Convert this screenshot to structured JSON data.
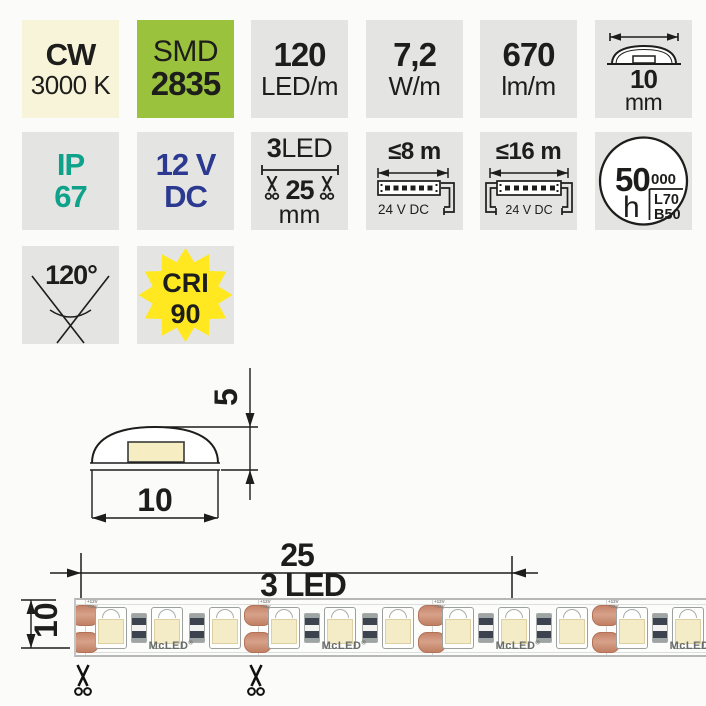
{
  "colors": {
    "badge_gray": "#e4e5e3",
    "badge_cream": "#f8f4d9",
    "badge_green": "#9ac23c",
    "ip_teal": "#0fa28b",
    "voltage_navy": "#2b3990",
    "cri_yellow": "#ffe81f",
    "copper_pad": "#c98d72",
    "led_cream": "#f4ecc6",
    "text": "#1d1d1b"
  },
  "badges": {
    "row1": [
      {
        "line1": "CW",
        "line2": "3000 K"
      },
      {
        "line1": "SMD",
        "line2": "2835"
      },
      {
        "line1": "120",
        "line2": "LED/m"
      },
      {
        "line1": "7,2",
        "line2": "W/m"
      },
      {
        "line1": "670",
        "line2": "lm/m"
      },
      {
        "value": "10",
        "unit": "mm"
      }
    ],
    "row2": [
      {
        "line1": "IP",
        "line2": "67"
      },
      {
        "line1": "12 V",
        "line2": "DC"
      },
      {
        "count": "3",
        "count_label": "LED",
        "pitch": "25",
        "unit": "mm"
      },
      {
        "max": "≤8 m",
        "supply": "24 V DC"
      },
      {
        "max": "≤16 m",
        "supply": "24 V DC"
      },
      {
        "big": "50",
        "small": "000",
        "unit": "h",
        "l": "L70",
        "b": "B50"
      }
    ],
    "row3": [
      {
        "angle": "120°"
      },
      {
        "line1": "CRI",
        "line2": "90"
      }
    ]
  },
  "drawings": {
    "cross_section": {
      "height_dim": "5",
      "width_dim": "10"
    },
    "strip": {
      "pitch_dim": "25",
      "pitch_label": "3 LED",
      "width_dim": "10",
      "brand": "McLED",
      "reg": "®",
      "marking": "+12V"
    }
  }
}
